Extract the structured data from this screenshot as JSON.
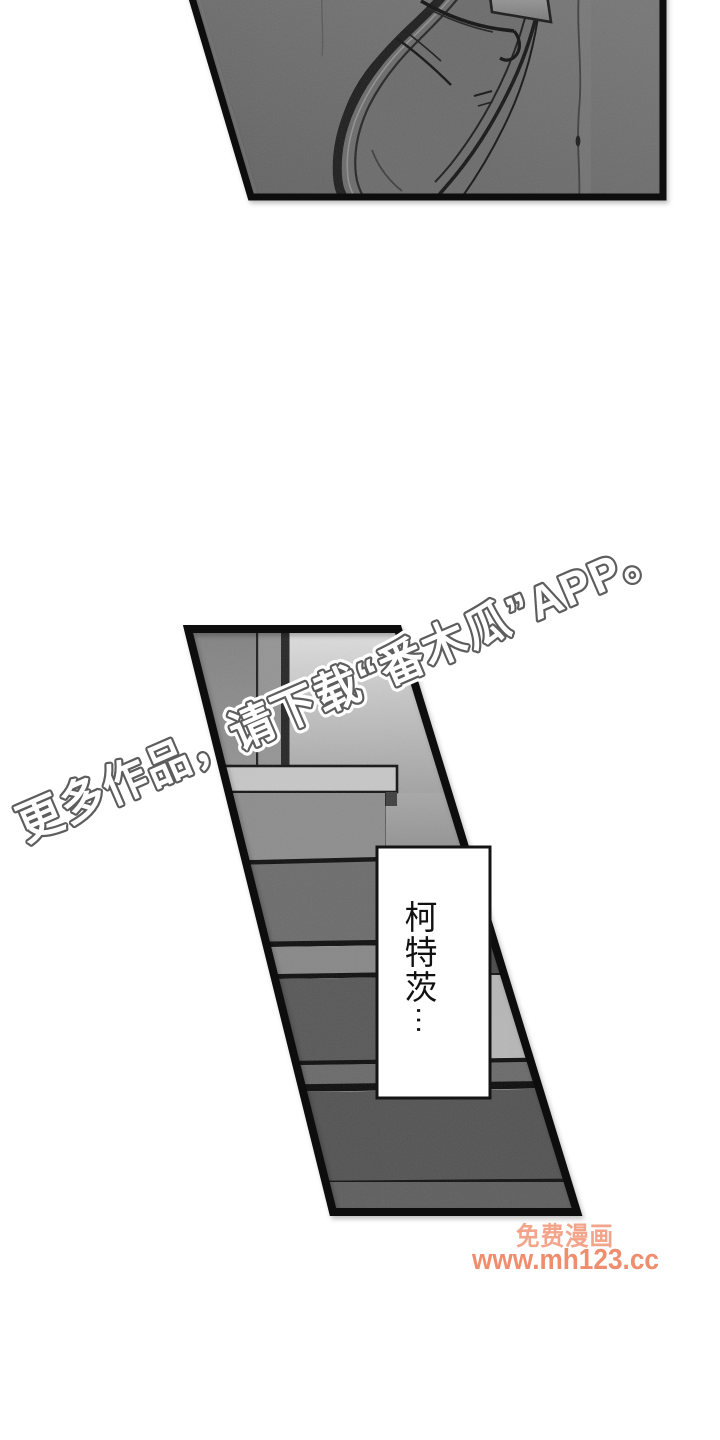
{
  "artwork": {
    "diagonal_watermark": {
      "text": "更多作品，请下载“番木瓜”APP。",
      "fill": "#ffffff",
      "outline": "#5d5d5d"
    },
    "speech_bubble": {
      "full_text": "柯特茨…",
      "char_1": "柯",
      "char_2": "特",
      "char_3": "茨",
      "ellipsis": "…"
    },
    "site_watermark": {
      "line_1": "免费漫画",
      "line_2": "www.mh123.cc",
      "line_1_color": "#f3a58c",
      "line_2_color": "#ef8e6f"
    }
  }
}
